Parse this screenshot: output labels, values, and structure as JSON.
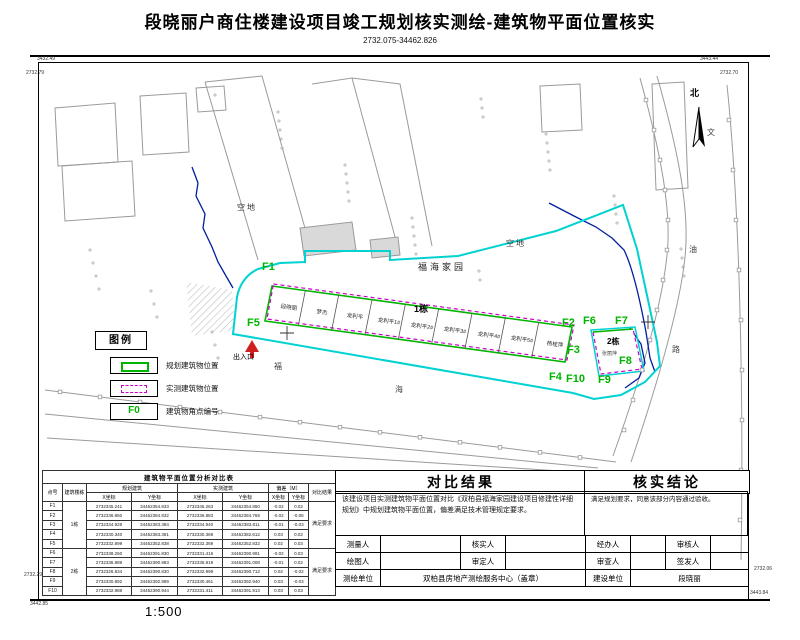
{
  "title": "段晓丽户商住楼建设项目竣工规划核实测绘-建筑物平面位置核实",
  "subtitle": "2732.075-34462.826",
  "scale_label": "1:500",
  "frame_labels": {
    "tl_a": "3432.49",
    "tl_b": "2732.79",
    "tr_a": "3443.44",
    "tr_b": "2732.70",
    "bl_a": "2732.29",
    "bl_b": "3442.85",
    "br_a": "2732.06",
    "br_b": "3443.84"
  },
  "map": {
    "north_label": "北",
    "site_name": "福海家园",
    "vacant_label_1": "空地",
    "vacant_label_2": "空地",
    "entrance_label": "出入口",
    "road_chars": {
      "fu": "福",
      "hai": "海",
      "lu": "路",
      "wen": "文",
      "you": "油"
    },
    "building1": {
      "name": "1栋",
      "units": [
        "段晓丽",
        "梦杰",
        "龙利平",
        "龙利平1#",
        "龙利平2#",
        "龙利平3#",
        "龙利平4#",
        "龙利平5#",
        "杨桂萍"
      ]
    },
    "building2": {
      "name": "2栋",
      "owner": "张丽萍"
    },
    "points": [
      "F1",
      "F2",
      "F3",
      "F4",
      "F5",
      "F6",
      "F7",
      "F8",
      "F9",
      "F10"
    ]
  },
  "legend": {
    "title": "图例",
    "items": [
      {
        "type": "planned",
        "label": "规划建筑物位置"
      },
      {
        "type": "measured",
        "label": "实测建筑物位置"
      },
      {
        "type": "point",
        "symbol": "F0",
        "label": "建筑物角点编号"
      }
    ]
  },
  "analysis_table": {
    "title": "建筑物平面位置分析对比表",
    "col_point": "点号",
    "col_building": "建筑楼栋",
    "col_planned": "规划建筑",
    "col_measured": "实测建筑",
    "col_dev": "偏差（M）",
    "col_result": "对比结果",
    "col_x": "X坐标",
    "col_y": "Y坐标",
    "groups": [
      {
        "building": "1栋",
        "result": "满足要求"
      },
      {
        "building": "2栋",
        "result": "满足要求"
      }
    ],
    "rows": [
      {
        "point": "F1",
        "px": "2732345.241",
        "py": "34462354.833",
        "mx": "2732345.263",
        "my": "34462354.850",
        "dx": "-0.02",
        "dy": "0.02"
      },
      {
        "point": "F2",
        "px": "2732336.850",
        "py": "34462384.832",
        "mx": "2732336.883",
        "my": "34462384.769",
        "dx": "-0.02",
        "dy": "-0.06"
      },
      {
        "point": "F3",
        "px": "2732334.928",
        "py": "34462383.384",
        "mx": "2732334.940",
        "my": "34462383.811",
        "dx": "-0.01",
        "dy": "-0.03"
      },
      {
        "point": "F4",
        "px": "2732330.340",
        "py": "34462383.381",
        "mx": "2732330.369",
        "my": "34462382.612",
        "dx": "0.03",
        "dy": "0.02"
      },
      {
        "point": "F5",
        "px": "2732332.899",
        "py": "34462352.838",
        "mx": "2732332.369",
        "my": "34462352.832",
        "dx": "0.02",
        "dy": "0.03"
      },
      {
        "point": "F6",
        "px": "2732338.260",
        "py": "34462391.830",
        "mx": "2732331.416",
        "my": "34462390.991",
        "dx": "-0.02",
        "dy": "0.03"
      },
      {
        "point": "F7",
        "px": "2732336.989",
        "py": "34462390.983",
        "mx": "2732336.919",
        "my": "34462391.008",
        "dx": "-0.01",
        "dy": "0.02"
      },
      {
        "point": "F8",
        "px": "2732326.834",
        "py": "34462390.830",
        "mx": "2732332.999",
        "my": "34462390.712",
        "dx": "0.02",
        "dy": "-0.02"
      },
      {
        "point": "F9",
        "px": "2732330.892",
        "py": "34462392.989",
        "mx": "2732330.461",
        "my": "34462392.940",
        "dx": "0.03",
        "dy": "-0.03"
      },
      {
        "point": "F10",
        "px": "2732332.988",
        "py": "34462390.944",
        "mx": "2732331.411",
        "my": "34462391.913",
        "dx": "0.03",
        "dy": "0.03"
      }
    ]
  },
  "comparison": {
    "title": "对比结果",
    "text": "该建设项目实测建筑物平面位置对比《双柏县福海家园建设项目修建性详细规划》中规划建筑物平面位置，偏差满足技术管理规定要求。"
  },
  "conclusion": {
    "title": "核实结论",
    "text": "满足规划要求，同意该部分内容通过验收。"
  },
  "signoff": {
    "row1": [
      {
        "label": "测量人",
        "value": ""
      },
      {
        "label": "核实人",
        "value": ""
      },
      {
        "label": "经办人",
        "value": ""
      },
      {
        "label": "审核人",
        "value": ""
      }
    ],
    "row2": [
      {
        "label": "绘图人",
        "value": ""
      },
      {
        "label": "审定人",
        "value": ""
      },
      {
        "label": "审查人",
        "value": ""
      },
      {
        "label": "签发人",
        "value": ""
      }
    ],
    "row3": {
      "org_label": "测绘单位",
      "org_value": "双柏县房地产测绘服务中心（盖章）",
      "builder_label": "建设单位",
      "builder_value": "段晓丽"
    }
  },
  "colors": {
    "planned_green": "#00b400",
    "measured_magenta": "#cc00cc",
    "boundary_cyan": "#00d2d2",
    "stream_navy": "#001f9e",
    "entrance_red": "#cf1f1f"
  }
}
